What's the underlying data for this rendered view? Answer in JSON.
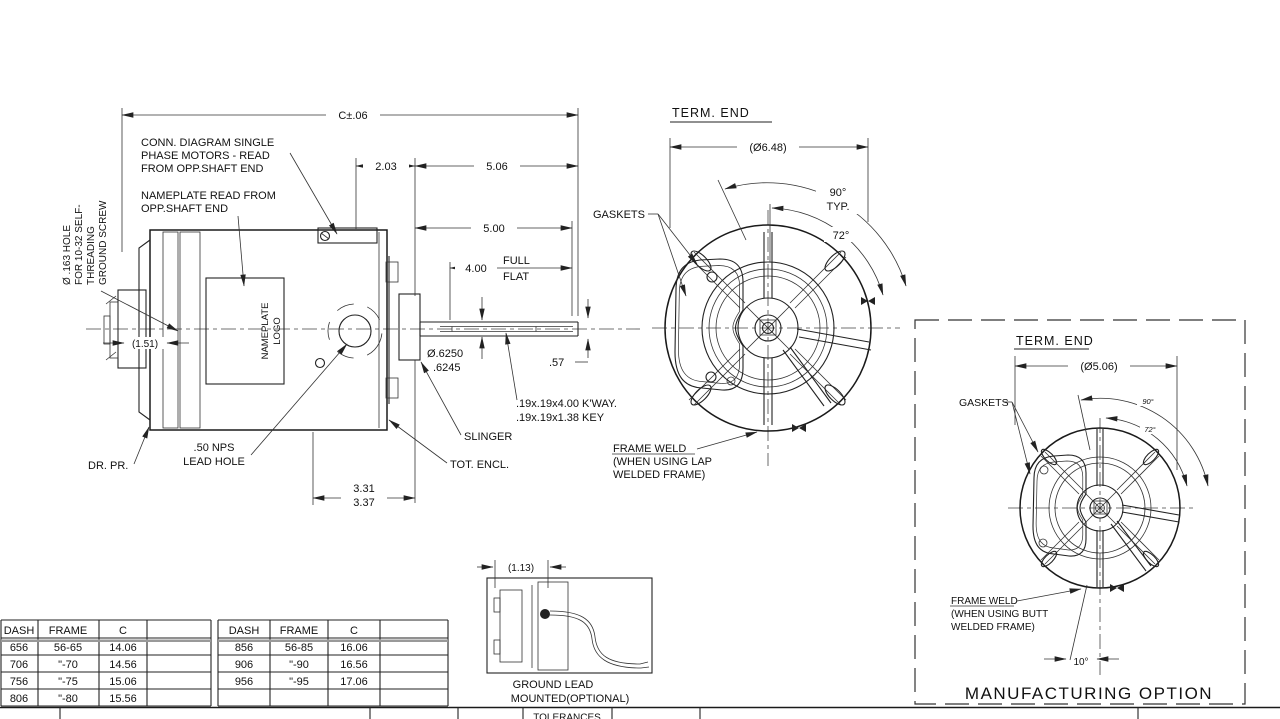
{
  "side_view": {
    "conn_diagram": [
      "CONN. DIAGRAM SINGLE",
      "PHASE MOTORS - READ",
      "FROM OPP.SHAFT END"
    ],
    "nameplate_note": [
      "NAMEPLATE READ FROM",
      "OPP.SHAFT END"
    ],
    "ground_screw_note": [
      "Ø .163 HOLE",
      "FOR 10-32 SELF-",
      "THREADING",
      "GROUND SCREW"
    ],
    "nameplate_logo": [
      "NAMEPLATE",
      "LOGO"
    ],
    "lead_hole_label": [
      ".50 NPS",
      "LEAD HOLE"
    ],
    "drain_label": "DR. PR.",
    "slinger_label": "SLINGER",
    "enclosure_label": "TOT. ENCL.",
    "keyway_note": [
      ".19x.19x4.00 K'WAY.",
      ".19x.19x1.38 KEY"
    ],
    "dims": {
      "overall": "C±.06",
      "d203": "2.03",
      "d506": "5.06",
      "d500": "5.00",
      "d400": "4.00",
      "full": "FULL",
      "flat": "FLAT",
      "shaft_dia_hi": "Ø.6250",
      "shaft_dia_lo": ".6245",
      "flat_len": ".57",
      "hub": "(1.51)",
      "base1": "3.31",
      "base2": "3.37"
    }
  },
  "term_end_view": {
    "title": "TERM. END",
    "dia": "(Ø6.48)",
    "angle_90": "90°",
    "typ": "TYP.",
    "angle_72": "72°",
    "gaskets_label": "GASKETS",
    "frame_weld_note": [
      "FRAME WELD",
      "(WHEN USING LAP",
      "WELDED FRAME)"
    ]
  },
  "ground_lead_inset": {
    "dim": "(1.13)",
    "caption": [
      "GROUND LEAD",
      "MOUNTED(OPTIONAL)"
    ]
  },
  "mfg_option_inset": {
    "title": "TERM. END",
    "dia": "(Ø5.06)",
    "angle_90": "90°",
    "angle_72": "72°",
    "angle_10": "10°",
    "gaskets_label": "GASKETS",
    "frame_weld_note": [
      "FRAME WELD",
      "(WHEN USING BUTT",
      "WELDED FRAME)"
    ],
    "caption": "MANUFACTURING OPTION"
  },
  "tables": {
    "left": {
      "headers": [
        "DASH",
        "FRAME",
        "C",
        ""
      ],
      "rows": [
        [
          "656",
          "56-65",
          "14.06"
        ],
        [
          "706",
          "\"-70",
          "14.56"
        ],
        [
          "756",
          "\"-75",
          "15.06"
        ],
        [
          "806",
          "\"-80",
          "15.56"
        ]
      ]
    },
    "right": {
      "headers": [
        "DASH",
        "FRAME",
        "C",
        ""
      ],
      "rows": [
        [
          "856",
          "56-85",
          "16.06"
        ],
        [
          "906",
          "\"-90",
          "16.56"
        ],
        [
          "956",
          "\"-95",
          "17.06"
        ]
      ]
    }
  },
  "title_block": {
    "tolerances": "TOLERANCES"
  }
}
